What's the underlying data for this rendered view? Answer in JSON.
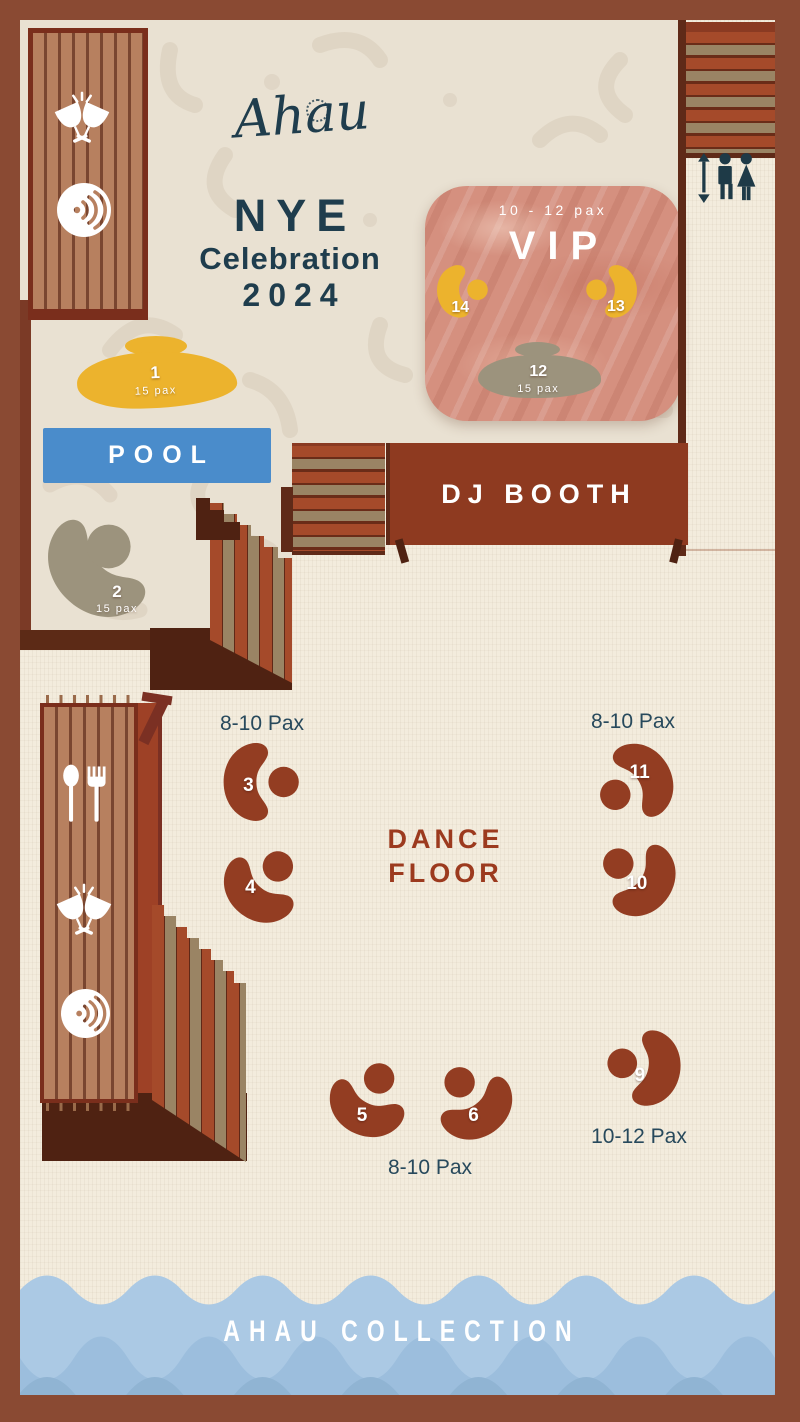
{
  "brand": {
    "logo": "Ahau"
  },
  "title": {
    "line1": "NYE",
    "line2": "Celebration",
    "line3": "2024"
  },
  "areas": {
    "vip": {
      "capacity": "10 - 12 pax",
      "label": "VIP"
    },
    "pool": {
      "label": "POOL"
    },
    "dj_booth": {
      "label": "DJ BOOTH"
    },
    "dance_floor": {
      "line1": "DANCE",
      "line2": "FLOOR"
    },
    "footer": {
      "label": "AHAU COLLECTION"
    }
  },
  "zone_labels": {
    "tables_3_4": "8-10 Pax",
    "tables_10_11": "8-10 Pax",
    "tables_5_6": "8-10 Pax",
    "table_9": "10-12 Pax"
  },
  "tables": {
    "t1": {
      "number": "1",
      "pax": "15 pax"
    },
    "t2": {
      "number": "2",
      "pax": "15 pax"
    },
    "t3": {
      "number": "3"
    },
    "t4": {
      "number": "4"
    },
    "t5": {
      "number": "5"
    },
    "t6": {
      "number": "6"
    },
    "t9": {
      "number": "9"
    },
    "t10": {
      "number": "10"
    },
    "t11": {
      "number": "11"
    },
    "t12": {
      "number": "12",
      "pax": "15 pax"
    },
    "t13": {
      "number": "13"
    },
    "t14": {
      "number": "14"
    }
  },
  "icons": {
    "cheers": "two clinking wine glasses",
    "speaker": "sound waves in circle",
    "cutlery": "spoon and fork",
    "restroom": "man and woman with up-down arrow",
    "logo_badge": "circular Ahau Collection stamp"
  },
  "colors": {
    "border": "#8a4a33",
    "wall": "#5f2a18",
    "wall2": "#5c2a16",
    "dark": "#4f2212",
    "terrace": "#e9e1d2",
    "motif": "#d8ccba",
    "floor": "#f3ecdd",
    "rust": "#933d22",
    "booth": "#8e3a20",
    "dance": "#9c3a1e",
    "stair-red": "#a54a2a",
    "stair-tan": "#9a8464",
    "slat": "#b7805f",
    "slat-gap": "#7a4630",
    "frame": "#7a2e1c",
    "yellow": "#ecb32d",
    "olive": "#9c937d",
    "pool": "#4a8ccb",
    "teal": "#1f3d4d",
    "vip": "#d5907f",
    "wave1": "#abc9e4",
    "wave2": "#9cbedd",
    "wave3": "#90b4d3"
  }
}
